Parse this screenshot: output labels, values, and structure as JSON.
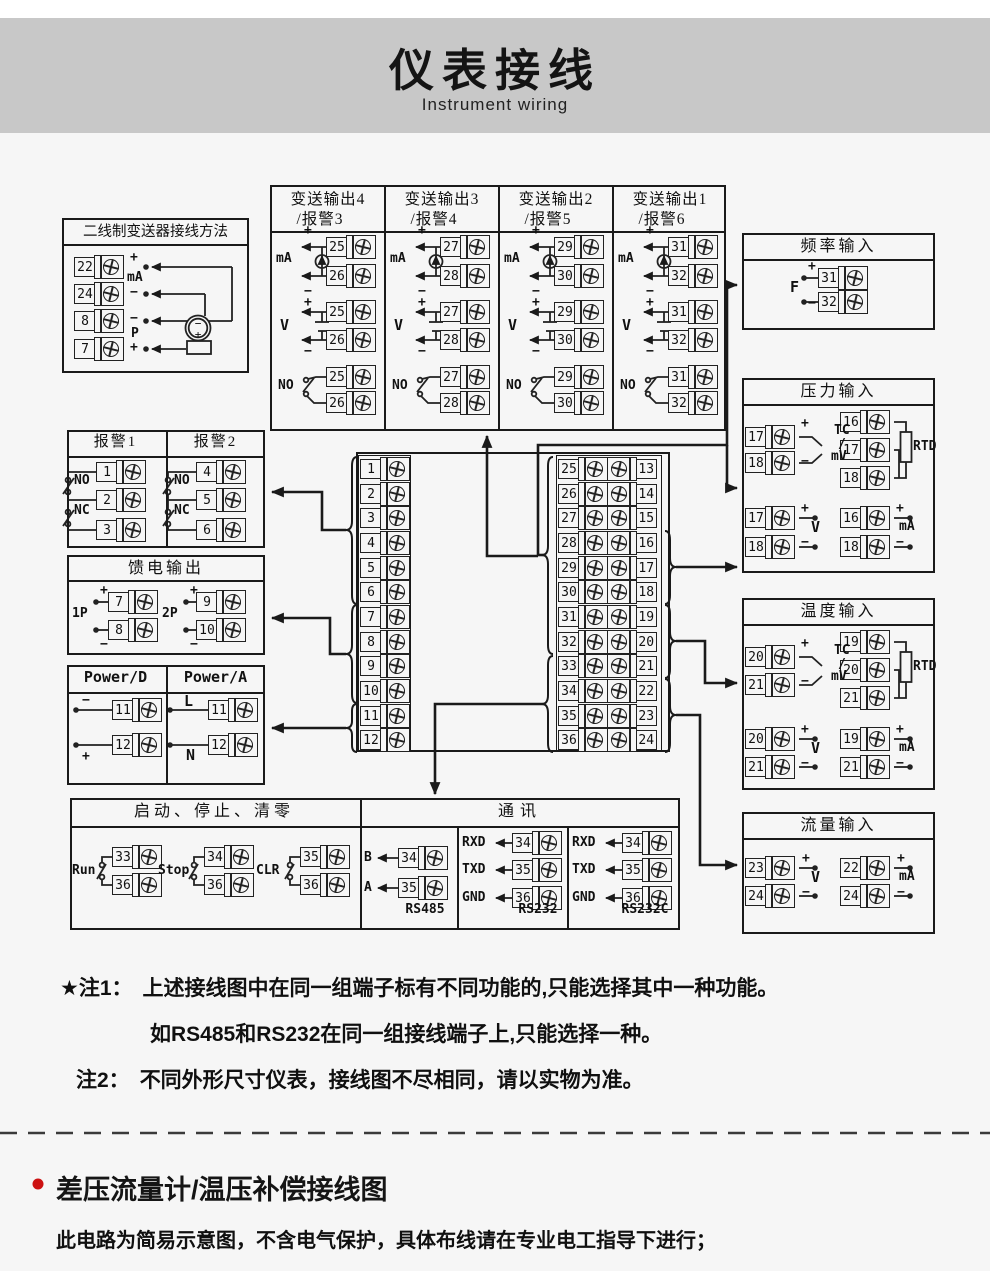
{
  "header": {
    "title": "仪表接线",
    "subtitle": "Instrument wiring"
  },
  "sym": {
    "p": "+",
    "m": "−",
    "v": "V",
    "ma": "mA",
    "tc1": "TC",
    "tc2": "/",
    "tc3": "mV",
    "rtd": "RTD",
    "no": "NO",
    "nc": "NC",
    "f": "F"
  },
  "two_wire": {
    "title": "二线制变送器接线方法",
    "t": [
      "22",
      "24",
      "8",
      "7"
    ],
    "s": [
      "+",
      "mA",
      "−",
      "−",
      "P",
      "+"
    ],
    "tx": [
      "−",
      "+"
    ]
  },
  "transmit": {
    "cols": [
      {
        "t1": "变送输出4",
        "t2": "/报警3",
        "a": "25",
        "b": "26"
      },
      {
        "t1": "变送输出3",
        "t2": "/报警4",
        "a": "27",
        "b": "28"
      },
      {
        "t1": "变送输出2",
        "t2": "/报警5",
        "a": "29",
        "b": "30"
      },
      {
        "t1": "变送输出1",
        "t2": "/报警6",
        "a": "31",
        "b": "32"
      }
    ]
  },
  "freq": {
    "title": "频率输入",
    "a": "31",
    "b": "32"
  },
  "pressure": {
    "title": "压力输入",
    "tc": [
      "17",
      "18"
    ],
    "rtd": [
      "16",
      "17",
      "18"
    ],
    "v": [
      "17",
      "18"
    ],
    "ma": [
      "16",
      "18"
    ]
  },
  "temp": {
    "title": "温度输入",
    "tc": [
      "20",
      "21"
    ],
    "rtd": [
      "19",
      "20",
      "21"
    ],
    "v": [
      "20",
      "21"
    ],
    "ma": [
      "19",
      "21"
    ]
  },
  "flow": {
    "title": "流量输入",
    "v": [
      "23",
      "24"
    ],
    "ma": [
      "22",
      "24"
    ]
  },
  "alarm": {
    "t1": "报警1",
    "t2": "报警2",
    "c1": [
      "1",
      "2",
      "3"
    ],
    "c2": [
      "4",
      "5",
      "6"
    ]
  },
  "feed": {
    "title": "馈电输出",
    "g1": {
      "n": "1P",
      "a": "7",
      "b": "8"
    },
    "g2": {
      "n": "2P",
      "a": "9",
      "b": "10"
    }
  },
  "power": {
    "t1": "Power/D",
    "t2": "Power/A",
    "d": {
      "s1": "−",
      "s2": "+",
      "a": "11",
      "b": "12"
    },
    "a": {
      "s1": "L",
      "s2": "N",
      "a": "11",
      "b": "12"
    }
  },
  "central": {
    "left": [
      "1",
      "2",
      "3",
      "4",
      "5",
      "6",
      "7",
      "8",
      "9",
      "10",
      "11",
      "12"
    ],
    "mid": [
      "25",
      "26",
      "27",
      "28",
      "29",
      "30",
      "31",
      "32",
      "33",
      "34",
      "35",
      "36"
    ],
    "right": [
      "13",
      "14",
      "15",
      "16",
      "17",
      "18",
      "19",
      "20",
      "21",
      "22",
      "23",
      "24"
    ]
  },
  "runstop": {
    "title": "启动、停止、清零",
    "g": [
      {
        "n": "Run",
        "a": "33",
        "b": "36"
      },
      {
        "n": "Stop",
        "a": "34",
        "b": "36"
      },
      {
        "n": "CLR",
        "a": "35",
        "b": "36"
      }
    ]
  },
  "comm": {
    "title": "通讯",
    "rs485": {
      "name": "RS485",
      "p1": "B",
      "p2": "A",
      "a": "34",
      "b": "35"
    },
    "rs232": {
      "name": "RS232",
      "p1": "RXD",
      "p2": "TXD",
      "p3": "GND",
      "a": "34",
      "b": "35",
      "c": "36"
    },
    "rs232c": {
      "name": "RS232C",
      "p1": "RXD",
      "p2": "TXD",
      "p3": "GND",
      "a": "34",
      "b": "35",
      "c": "36"
    }
  },
  "notes": {
    "n1_label": "★注1：",
    "n1_line1": "上述接线图中在同一组端子标有不同功能的,只能选择其中一种功能。",
    "n1_line2": "如RS485和RS232在同一组接线端子上,只能选择一种。",
    "n2_label": "注2：",
    "n2_text": "不同外形尺寸仪表，接线图不尽相同，请以实物为准。"
  },
  "footer": {
    "heading": "差压流量计/温压补偿接线图",
    "note": "此电路为简易示意图，不含电气保护，具体布线请在专业电工指导下进行；"
  },
  "colors": {
    "header_bg": "#c8c8c8",
    "line": "#1a1a1a",
    "accent_red": "#cc1111",
    "page_bg": "#f6f6f6"
  }
}
